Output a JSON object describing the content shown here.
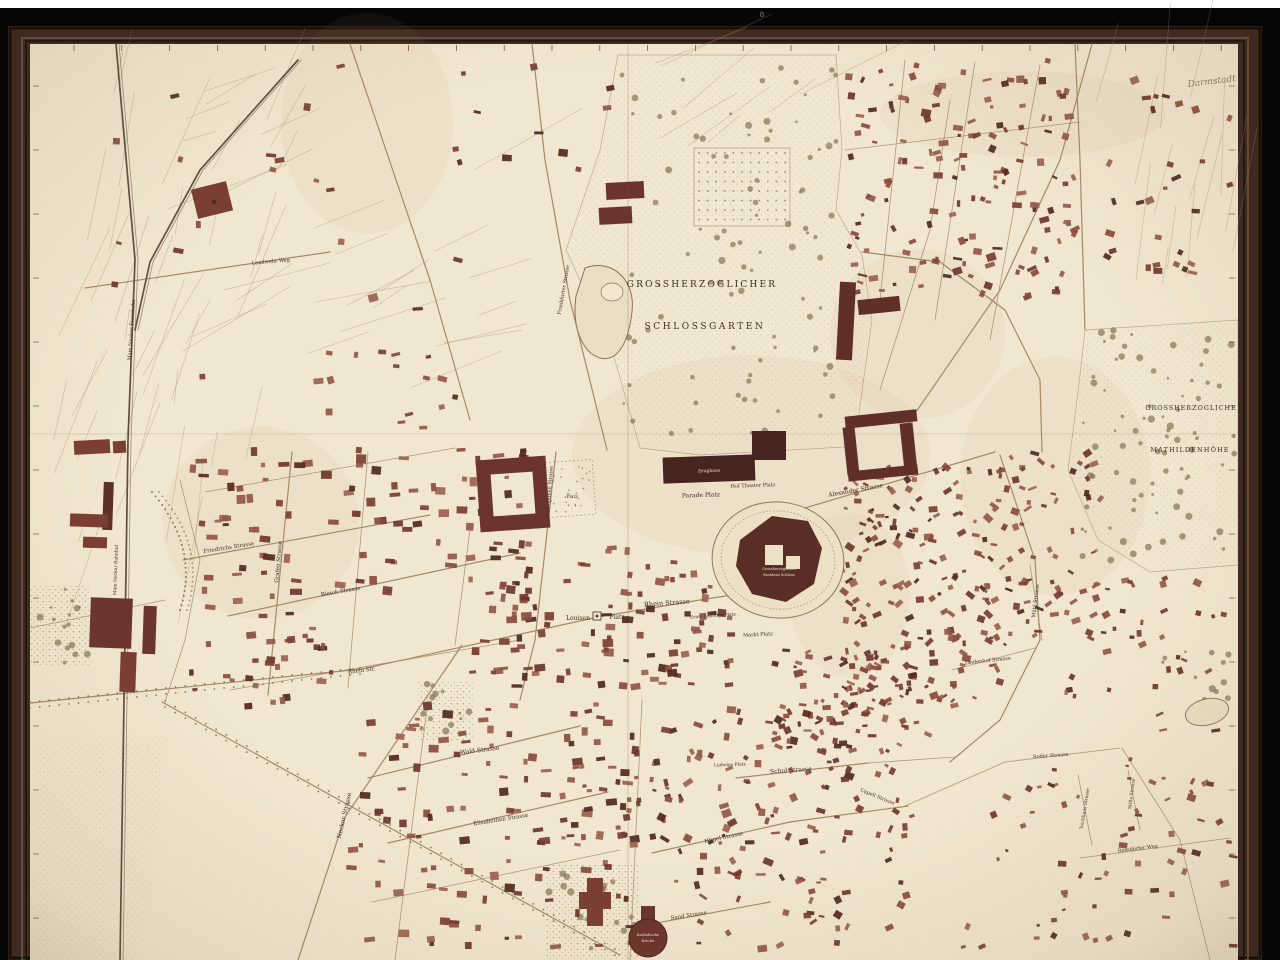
{
  "map": {
    "description": "Framed historical city plan of Darmstadt",
    "handwritten_note": "Darmstadt",
    "frame_mark": "8",
    "palette": {
      "paper": "#f1e6cf",
      "frame_wood": "#3d2b20",
      "frame_highlight": "#6b5242",
      "frame_shadow": "#1a100a",
      "surround_black": "#060606",
      "white_strip": "#ffffff",
      "building": "#7b3e35",
      "building_dark": "#52291f",
      "ink": "#3c2f24",
      "label_cream": "#ecdfc2",
      "road": "#a18a6b",
      "rail": "#5f4f3e",
      "park_dot": "#8a7d5c",
      "water": "#8a7258"
    },
    "area_labels": [
      {
        "t": "GROSSHERZOGLICHER",
        "x": 702,
        "y": 287,
        "s": 9,
        "r": 0,
        "ls": 2.2
      },
      {
        "t": "SCHLOSSGARTEN",
        "x": 705,
        "y": 329,
        "s": 9,
        "r": 0,
        "ls": 2.6
      },
      {
        "t": "GROSSHERZOGLICHE",
        "x": 1191,
        "y": 410,
        "s": 6.5,
        "r": 0,
        "ls": 0.9
      },
      {
        "t": "MATHILDENHÖHE",
        "x": 1190,
        "y": 452,
        "s": 6.5,
        "r": 0,
        "ls": 1.1
      }
    ],
    "street_labels": [
      {
        "t": "Parade Platz",
        "x": 701,
        "y": 497,
        "s": 6,
        "r": -2
      },
      {
        "t": "Hof Theater Platz",
        "x": 753,
        "y": 487,
        "s": 5,
        "r": -2
      },
      {
        "t": "Louisen",
        "x": 578,
        "y": 620,
        "s": 6,
        "r": 0
      },
      {
        "t": "Platz",
        "x": 617,
        "y": 619,
        "s": 6,
        "r": 0
      },
      {
        "t": "Rhein Strasse",
        "x": 667,
        "y": 605,
        "s": 6.5,
        "r": -4
      },
      {
        "t": "Rhein Str.",
        "x": 362,
        "y": 672,
        "s": 5.5,
        "r": -7
      },
      {
        "t": "Ernst Ludwigs Platz",
        "x": 713,
        "y": 617,
        "s": 4.5,
        "r": -4
      },
      {
        "t": "Markt Platz",
        "x": 758,
        "y": 636,
        "s": 5,
        "r": -3
      },
      {
        "t": "Schul Strasse",
        "x": 791,
        "y": 772,
        "s": 6,
        "r": -4
      },
      {
        "t": "Ludwigs Platz",
        "x": 730,
        "y": 766,
        "s": 4.5,
        "r": -2
      },
      {
        "t": "Wald Strasse",
        "x": 480,
        "y": 752,
        "s": 6,
        "r": -7
      },
      {
        "t": "Elisabethen Strasse",
        "x": 501,
        "y": 821,
        "s": 5.5,
        "r": -9
      },
      {
        "t": "Neckar Strasse",
        "x": 346,
        "y": 816,
        "s": 6,
        "r": -77
      },
      {
        "t": "Friedrichs Strasse",
        "x": 229,
        "y": 549,
        "s": 5.5,
        "r": -9
      },
      {
        "t": "Bleich Strasse",
        "x": 341,
        "y": 593,
        "s": 5.5,
        "r": -10
      },
      {
        "t": "Grafen Strasse",
        "x": 280,
        "y": 562,
        "s": 5.5,
        "r": -85
      },
      {
        "t": "Alexander Strasse",
        "x": 856,
        "y": 492,
        "s": 6,
        "r": -10
      },
      {
        "t": "Wilhelminen Strasse",
        "x": 551,
        "y": 492,
        "s": 5,
        "r": -86
      },
      {
        "t": "Platz",
        "x": 572,
        "y": 498,
        "s": 4.5,
        "r": 0
      },
      {
        "t": "Hügel Strasse",
        "x": 724,
        "y": 839,
        "s": 5.5,
        "r": -12
      },
      {
        "t": "Capell Strasse",
        "x": 877,
        "y": 798,
        "s": 5,
        "r": 22
      },
      {
        "t": "Sand Strasse",
        "x": 689,
        "y": 917,
        "s": 5.5,
        "r": -9
      },
      {
        "t": "Mühl Strasse",
        "x": 1037,
        "y": 601,
        "s": 5,
        "r": -83
      },
      {
        "t": "Lindenhof Strasse",
        "x": 988,
        "y": 662,
        "s": 5,
        "r": -6
      },
      {
        "t": "Soder Strasse",
        "x": 1051,
        "y": 757,
        "s": 5,
        "r": -4
      },
      {
        "t": "Teichhaus Strasse",
        "x": 1086,
        "y": 809,
        "s": 4.5,
        "r": -81
      },
      {
        "t": "Stifts Strasse",
        "x": 1133,
        "y": 794,
        "s": 4.5,
        "r": -83
      },
      {
        "t": "Rossdörfer Weg",
        "x": 1138,
        "y": 850,
        "s": 5,
        "r": -7
      },
      {
        "t": "Landwehr Weg",
        "x": 271,
        "y": 263,
        "s": 5,
        "r": -5
      },
      {
        "t": "Main Neckar Eisenbahn",
        "x": 133,
        "y": 330,
        "s": 5,
        "r": -86
      },
      {
        "t": "Main Neckar Bahnhof",
        "x": 117,
        "y": 570,
        "s": 4.5,
        "r": -88
      },
      {
        "t": "Frankfurter Strasse",
        "x": 565,
        "y": 290,
        "s": 5,
        "r": -80
      }
    ],
    "landmark_labels": [
      {
        "t": "Zeughaus",
        "x": 709,
        "y": 472,
        "s": 4.5,
        "r": -2,
        "c": "cream"
      },
      {
        "t": "Grossherzogliches",
        "x": 779,
        "y": 570,
        "s": 3.6,
        "r": 0,
        "c": "cream"
      },
      {
        "t": "Residenz Schloss",
        "x": 779,
        "y": 576,
        "s": 3.6,
        "r": 0,
        "c": "cream"
      },
      {
        "t": "Katholische",
        "x": 648,
        "y": 936,
        "s": 3.8,
        "r": 0,
        "c": "cream"
      },
      {
        "t": "Kirche",
        "x": 648,
        "y": 942,
        "s": 3.8,
        "r": 0,
        "c": "cream"
      }
    ]
  }
}
